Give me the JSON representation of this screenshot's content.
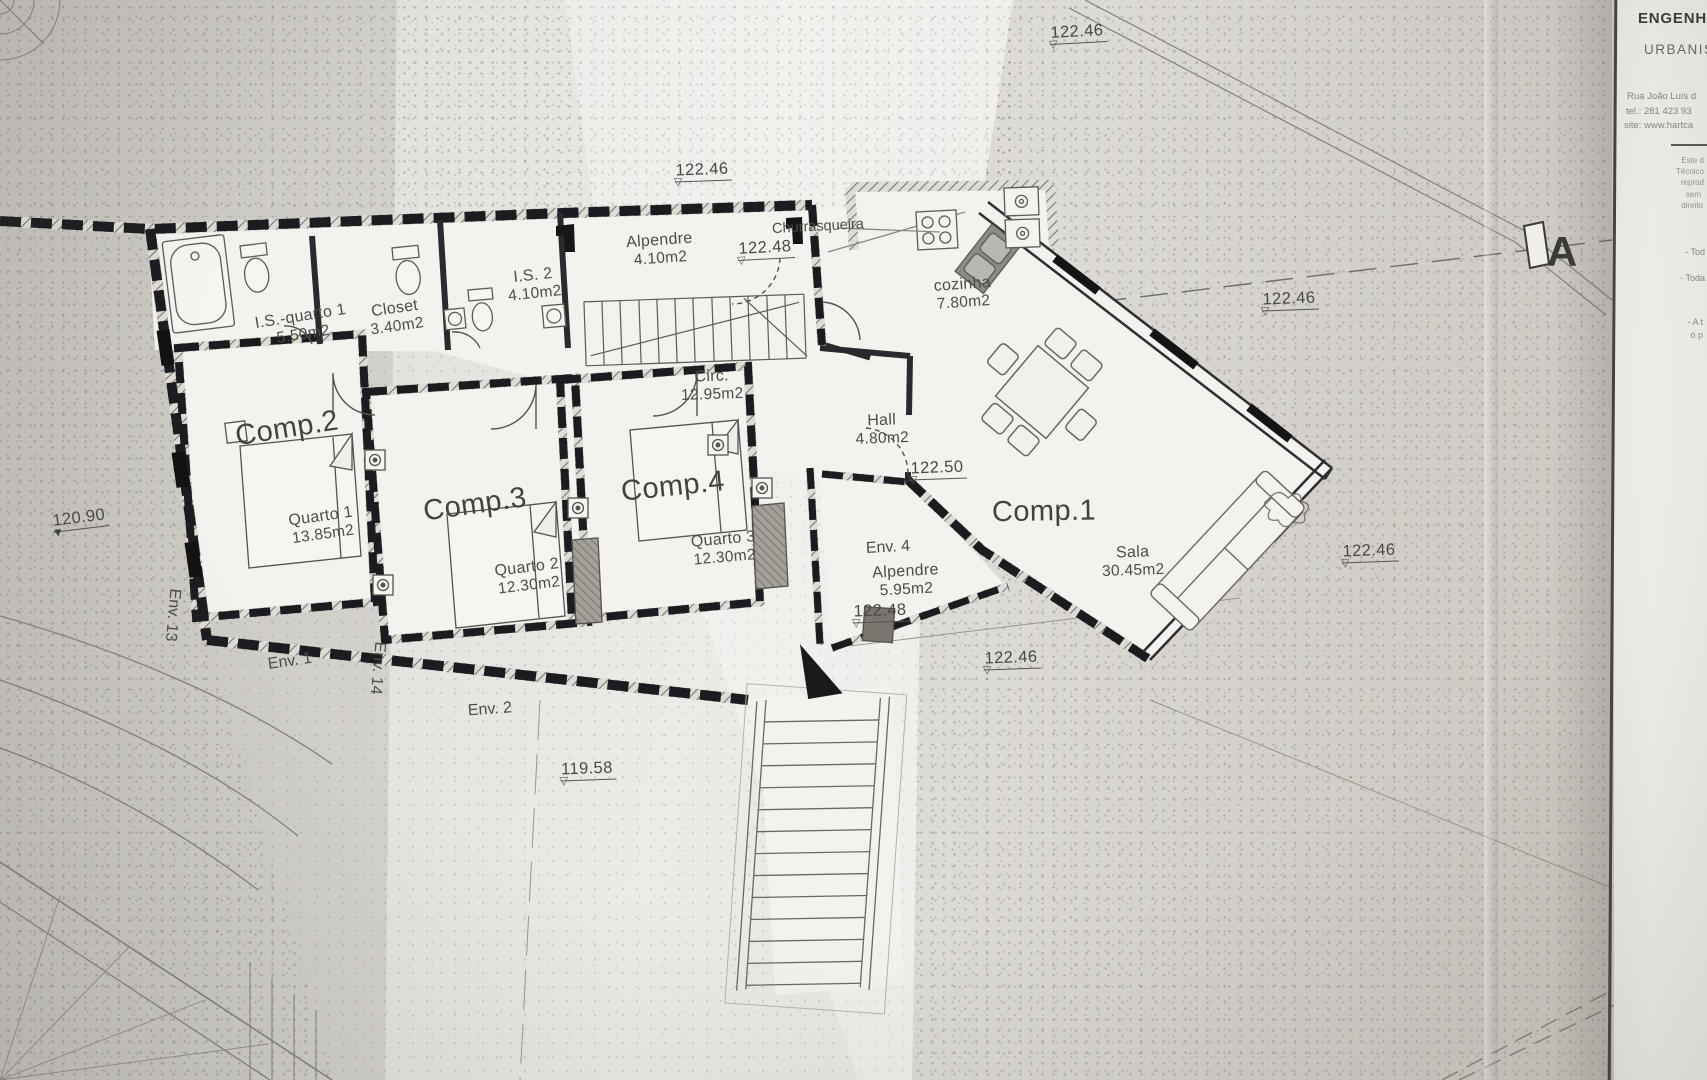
{
  "plan": {
    "rooms": {
      "comp1": {
        "name": "Comp.1"
      },
      "comp2": {
        "name": "Comp.2"
      },
      "comp3": {
        "name": "Comp.3"
      },
      "comp4": {
        "name": "Comp.4"
      },
      "quarto1": {
        "name": "Quarto 1",
        "area": "13.85m2"
      },
      "quarto2": {
        "name": "Quarto 2",
        "area": "12.30m2"
      },
      "quarto3": {
        "name": "Quarto 3",
        "area": "12.30m2"
      },
      "sala": {
        "name": "Sala",
        "area": "30.45m2"
      },
      "cozinha": {
        "name": "cozinha",
        "area": "7.80m2"
      },
      "hall": {
        "name": "Hall",
        "area": "4.80m2"
      },
      "circ": {
        "name": "Circ.",
        "area": "12.95m2"
      },
      "is2": {
        "name": "I.S. 2",
        "area": "4.10m2"
      },
      "is_quarto1": {
        "name": "I.S.-quarto 1",
        "area": "5.50m2"
      },
      "closet": {
        "name": "Closet",
        "area": "3.40m2"
      },
      "alpendre_norte": {
        "name": "Alpendre",
        "area": "4.10m2"
      },
      "alpendre_nascente": {
        "name": "Alpendre",
        "area": "5.95m2"
      },
      "churrasqueira": {
        "name": "Churrasqueira"
      },
      "env4": {
        "name": "Env. 4"
      }
    },
    "openings": {
      "env1": "Env. 1",
      "env2": "Env. 2",
      "env13": "Env. 13",
      "env14": "Env. 14"
    },
    "levels": {
      "top": "122.46",
      "upper_terrace": "122.46",
      "porch": "122.48",
      "boundary_right": "122.46",
      "hall": "122.50",
      "terrace_east": "122.48",
      "right_mid": "122.46",
      "stairs": "122.46",
      "west": "120.90",
      "south": "119.58"
    },
    "section_marker": "A"
  },
  "title_block": {
    "heading1": "ENGENHA",
    "heading2": "URBANIS",
    "address": "Rua João Luís d",
    "phone": "tel.: 281 423 93",
    "website": "site: www.hartca",
    "fine_print": [
      "Este d",
      "Técnico",
      "reprod",
      "sem",
      "direito"
    ],
    "notes": [
      "- Tod",
      "- Toda",
      "- A t",
      "o p"
    ]
  }
}
